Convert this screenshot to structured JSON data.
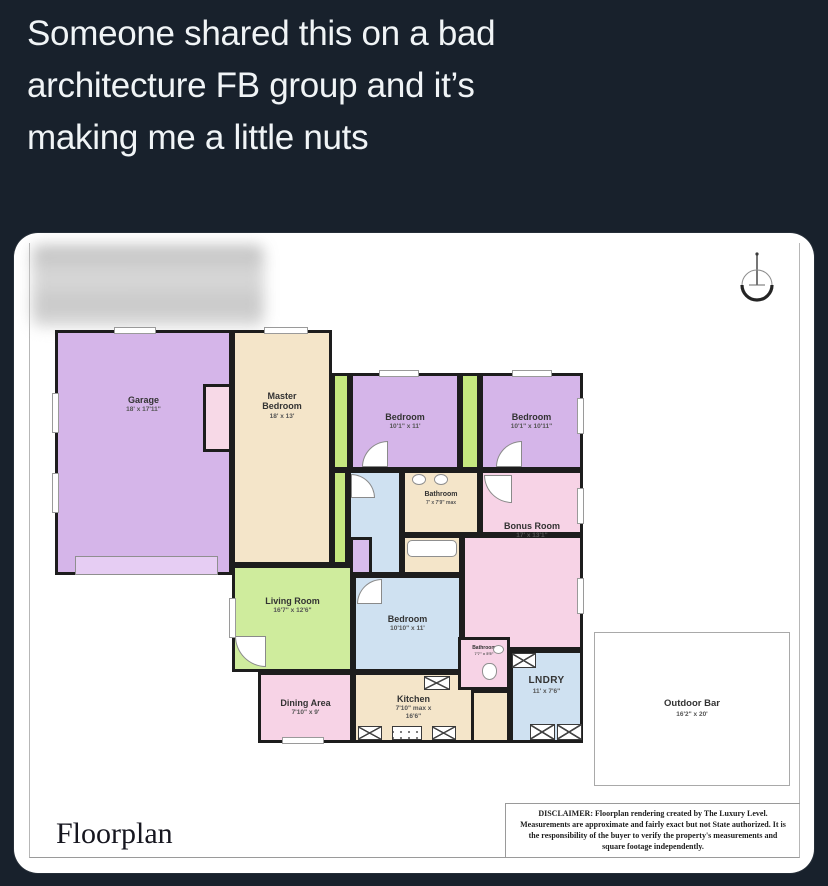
{
  "post": {
    "lines": [
      "Someone shared this on a bad",
      "architecture FB group and it’s",
      "making me a little nuts"
    ]
  },
  "floorplan": {
    "title": "Floorplan",
    "compass_icon": "north-compass-icon",
    "disclaimer": "DISCLAIMER: Floorplan rendering created by The Luxury Level. Measurements are approximate and fairly exact but not State authorized. It is the responsibility of the buyer to verify the property's measurements and square footage independently.",
    "rooms": [
      {
        "name": "Garage",
        "dims": "18' x 17'11\""
      },
      {
        "name": "Master Bedroom",
        "dims": "18' x 13'"
      },
      {
        "name": "Bedroom",
        "dims": "10'1\" x 11'"
      },
      {
        "name": "Bedroom",
        "dims": "10'1\" x 10'11\""
      },
      {
        "name": "Bathroom",
        "dims": "7' x 7'9\" max"
      },
      {
        "name": "Bonus Room",
        "dims": "17' x 13'1\""
      },
      {
        "name": "Living Room",
        "dims": "16'7\" x 12'6\""
      },
      {
        "name": "Bedroom",
        "dims": "10'10\" x 11'"
      },
      {
        "name": "Dining Area",
        "dims": "7'10\" x 9'"
      },
      {
        "name": "Kitchen",
        "dims": "7'10\" max x 16'6\""
      },
      {
        "name": "Bathroom",
        "dims": "7'7\" x 5'5\""
      },
      {
        "name": "LNDRY",
        "dims": "11' x 7'6\""
      },
      {
        "name": "Outdoor Bar",
        "dims": "16'2\" x 20'"
      }
    ]
  },
  "colors": {
    "page_bg": "#18212c",
    "post_text": "#f0f4f6",
    "card_bg": "#ffffff",
    "wall": "#1d1d1d",
    "room_purple": "#d5b5e9",
    "room_tan": "#f4e5c9",
    "room_green": "#cfec9d",
    "strip_green": "#c5e87f",
    "room_blue": "#cfe1f1",
    "room_pink": "#f7d3e6",
    "closet_pink": "#f7d9e7",
    "label_text": "#333333"
  }
}
